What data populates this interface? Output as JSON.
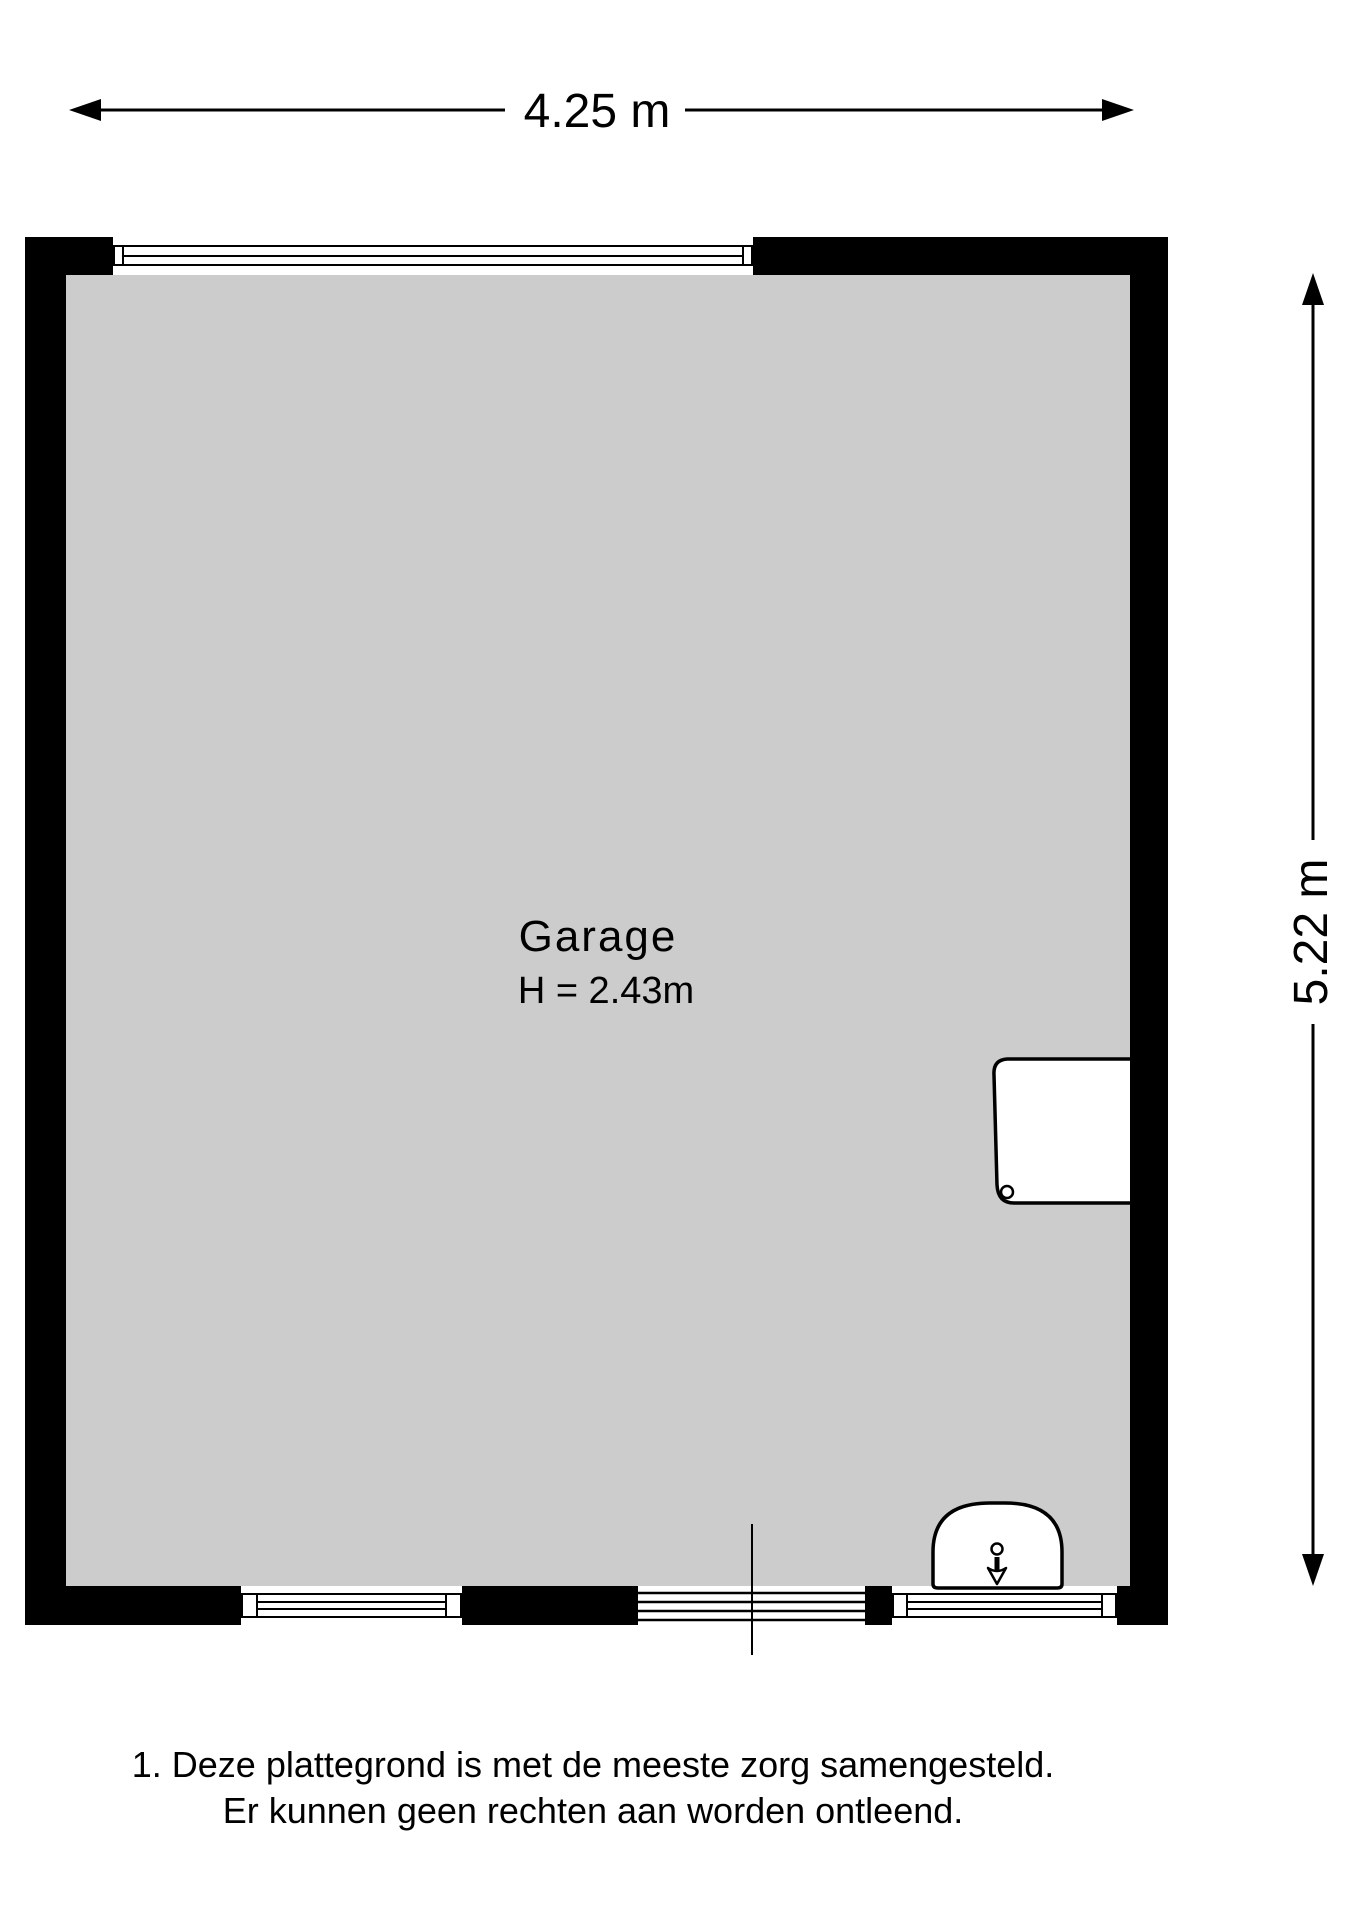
{
  "dimensions": {
    "width_label": "4.25 m",
    "depth_label": "5.22 m"
  },
  "room": {
    "name": "Garage",
    "ceiling_height_label": "H = 2.43m"
  },
  "disclaimer": {
    "line1": "1. Deze plattegrond is met de meeste zorg samengesteld.",
    "line2": "Er kunnen geen rechten aan worden ontleend."
  },
  "colors": {
    "wall": "#000000",
    "floor": "#cccccc",
    "line": "#000000",
    "background": "#ffffff"
  }
}
